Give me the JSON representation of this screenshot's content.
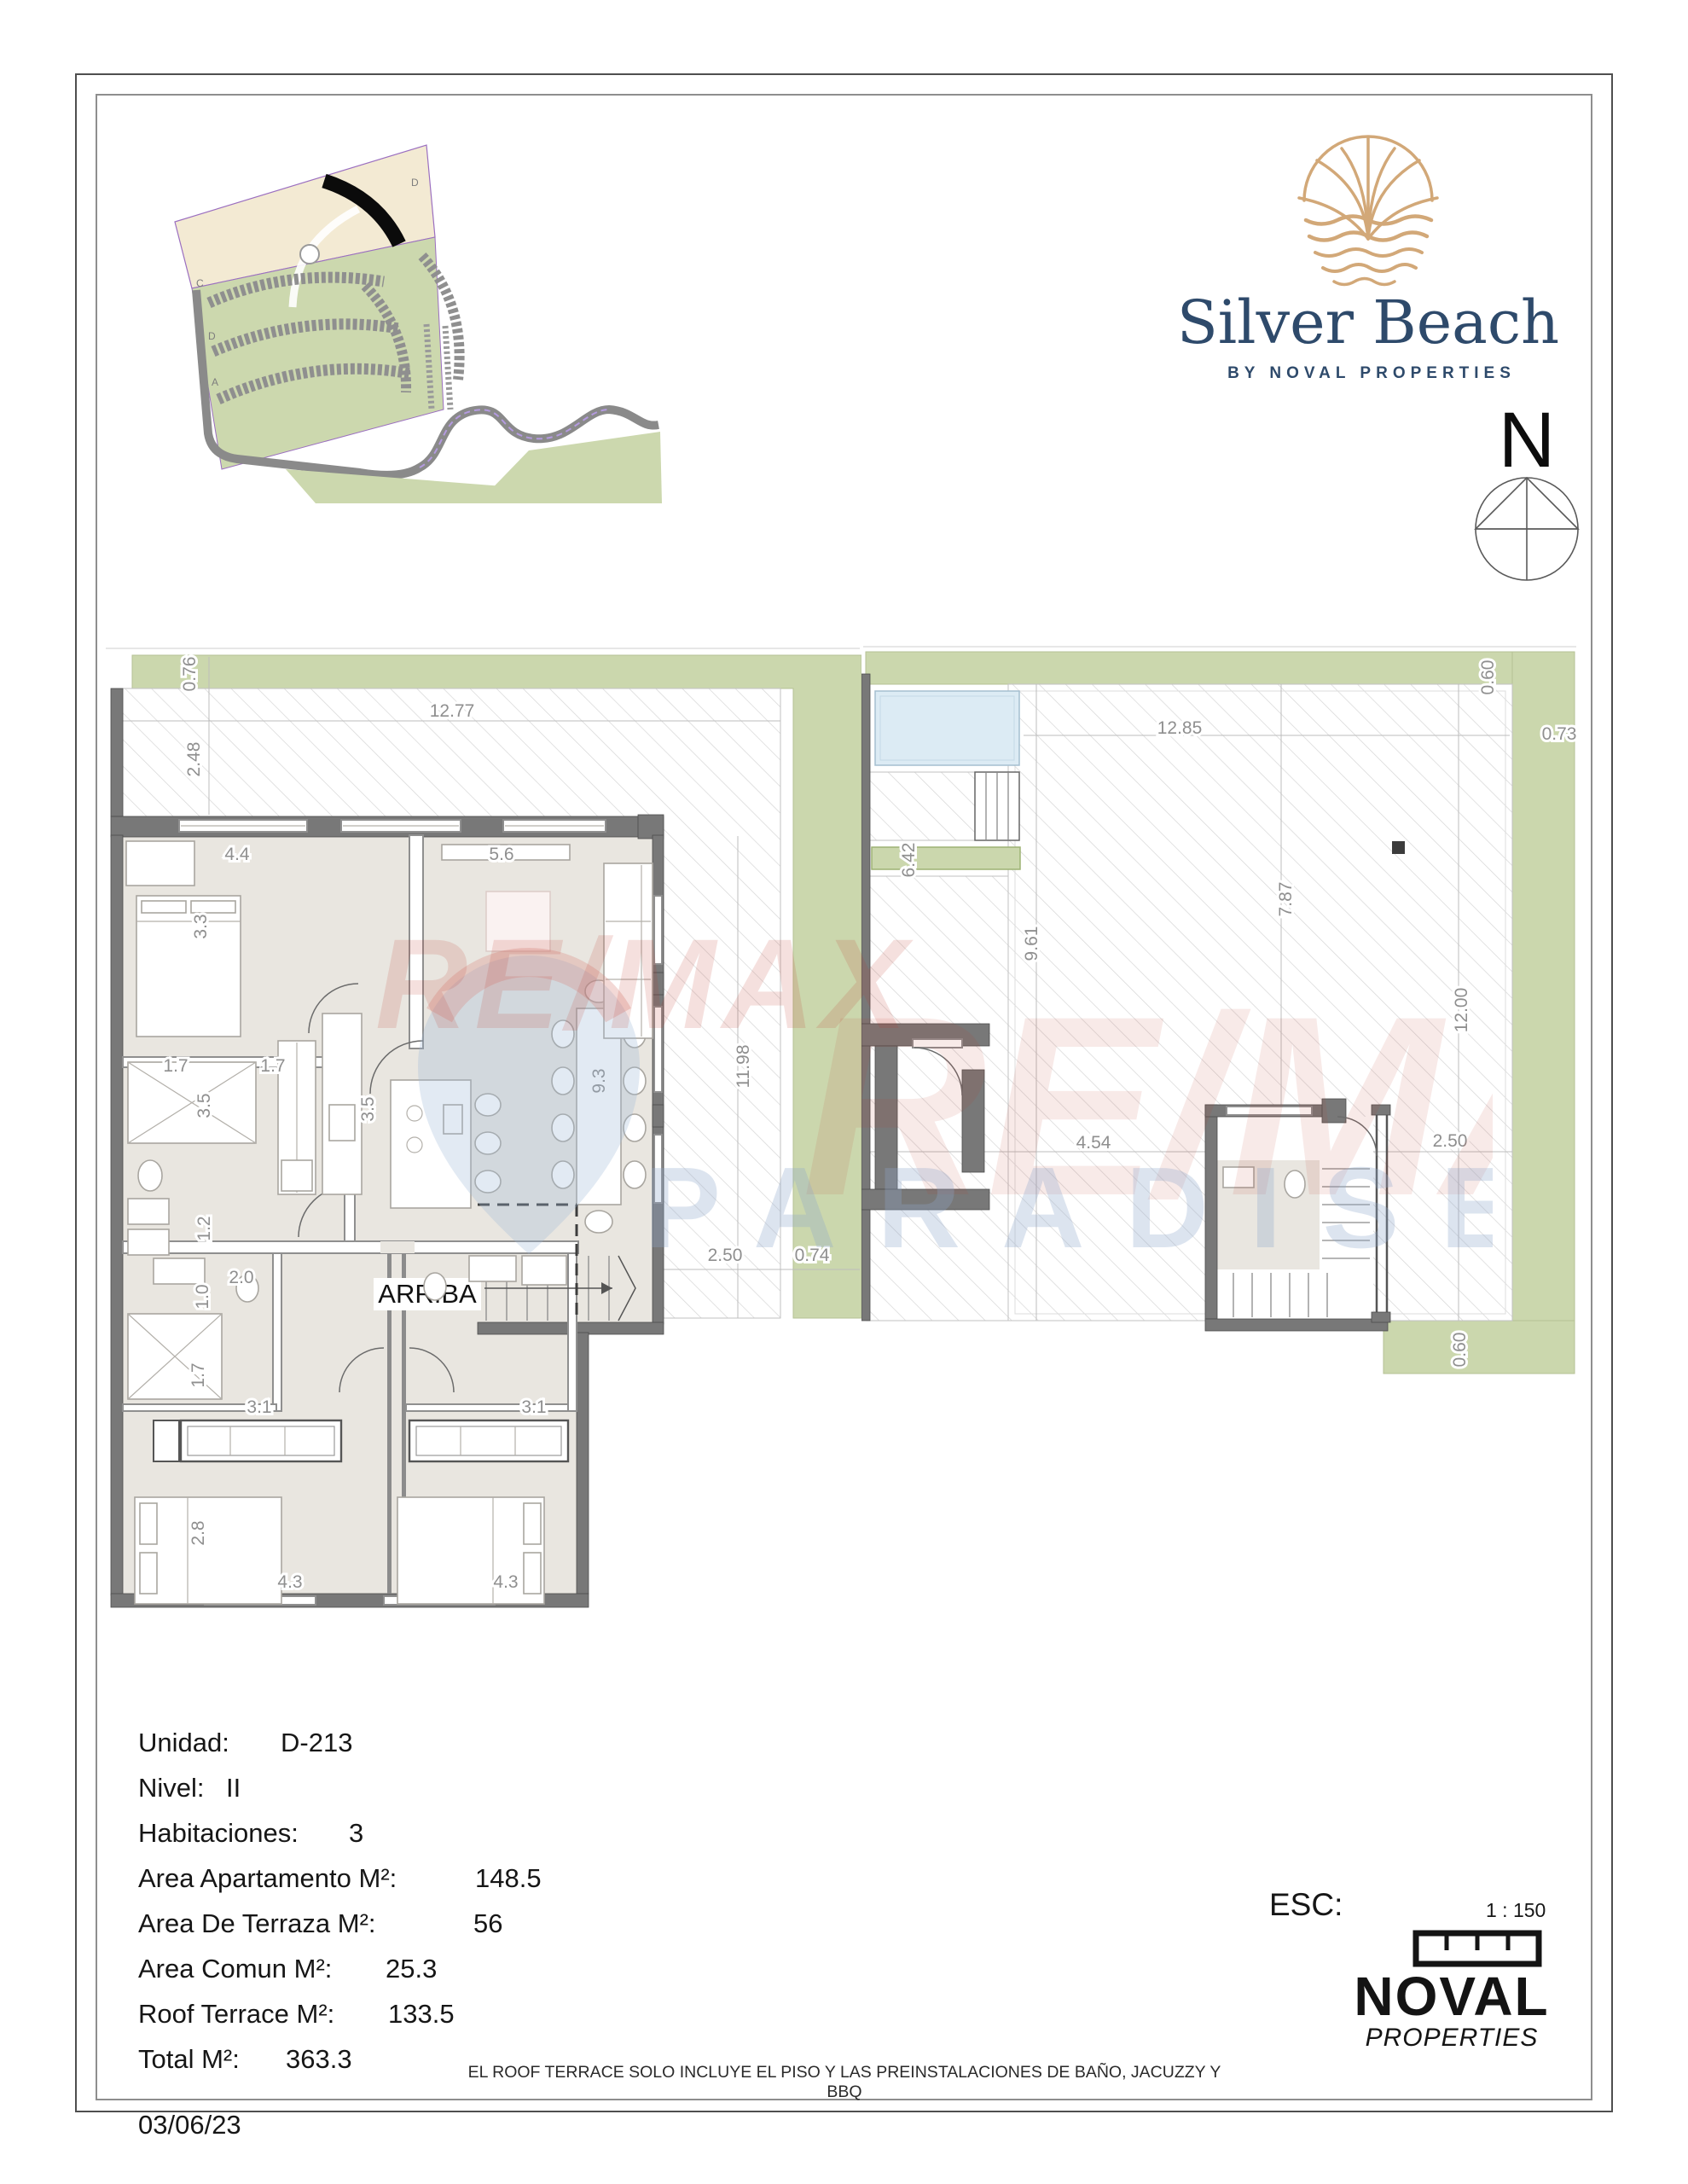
{
  "brand": {
    "name": "Silver Beach",
    "tagline": "BY NOVAL PROPERTIES"
  },
  "compass": {
    "label": "N"
  },
  "site_map": {
    "labels": {
      "c": "C",
      "d_top": "D",
      "d_mid": "D",
      "a": "A"
    }
  },
  "watermark": {
    "line1": "RE/MAX",
    "line2": "PARADISE"
  },
  "plans": {
    "left": {
      "stairs_label": "ARRIBA",
      "dims": {
        "g076": "0.76",
        "g1277": "12.77",
        "g248": "2.48",
        "g44": "4.4",
        "g56": "5.6",
        "g33": "3.3",
        "g17a": "1.7",
        "g17b": "1.7",
        "g35a": "3.5",
        "g35b": "3.5",
        "g12": "1.2",
        "g20": "2.0",
        "g10": "1.0",
        "g1198": "11.98",
        "g93": "9.3",
        "g250": "2.50",
        "g074": "0.74",
        "g17c": "1.7",
        "g31a": "3.1",
        "g31b": "3.1",
        "g28": "2.8",
        "g43a": "4.3",
        "g43b": "4.3"
      }
    },
    "right": {
      "dims": {
        "g060t": "0.60",
        "g1285": "12.85",
        "g073": "0.73",
        "g642": "6.42",
        "g961": "9.61",
        "g787": "7.87",
        "g1200": "12.00",
        "g250": "2.50",
        "g454": "4.54",
        "g060b": "0.60"
      }
    }
  },
  "unit_info": {
    "rows": [
      {
        "label": "Unidad:",
        "value": "D-213"
      },
      {
        "label": "Nivel:",
        "value": "II"
      },
      {
        "label": "Habitaciones:",
        "value": "3"
      },
      {
        "label": "Area Apartamento M²:",
        "value": "148.5"
      },
      {
        "label": "Area De Terraza M²:",
        "value": "56"
      },
      {
        "label": "Area Comun M²:",
        "value": "25.3"
      },
      {
        "label": "Roof Terrace M²:",
        "value": "133.5"
      },
      {
        "label": "Total M²:",
        "value": "363.3"
      }
    ],
    "date": "03/06/23"
  },
  "scale_block": {
    "label": "ESC:",
    "value": "1 : 150"
  },
  "noval_logo": {
    "name": "NOVAL",
    "sub": "PROPERTIES"
  },
  "disclaimer": "EL ROOF TERRACE SOLO INCLUYE EL PISO Y LAS PREINSTALACIONES DE BAÑO, JACUZZY Y BBQ"
}
